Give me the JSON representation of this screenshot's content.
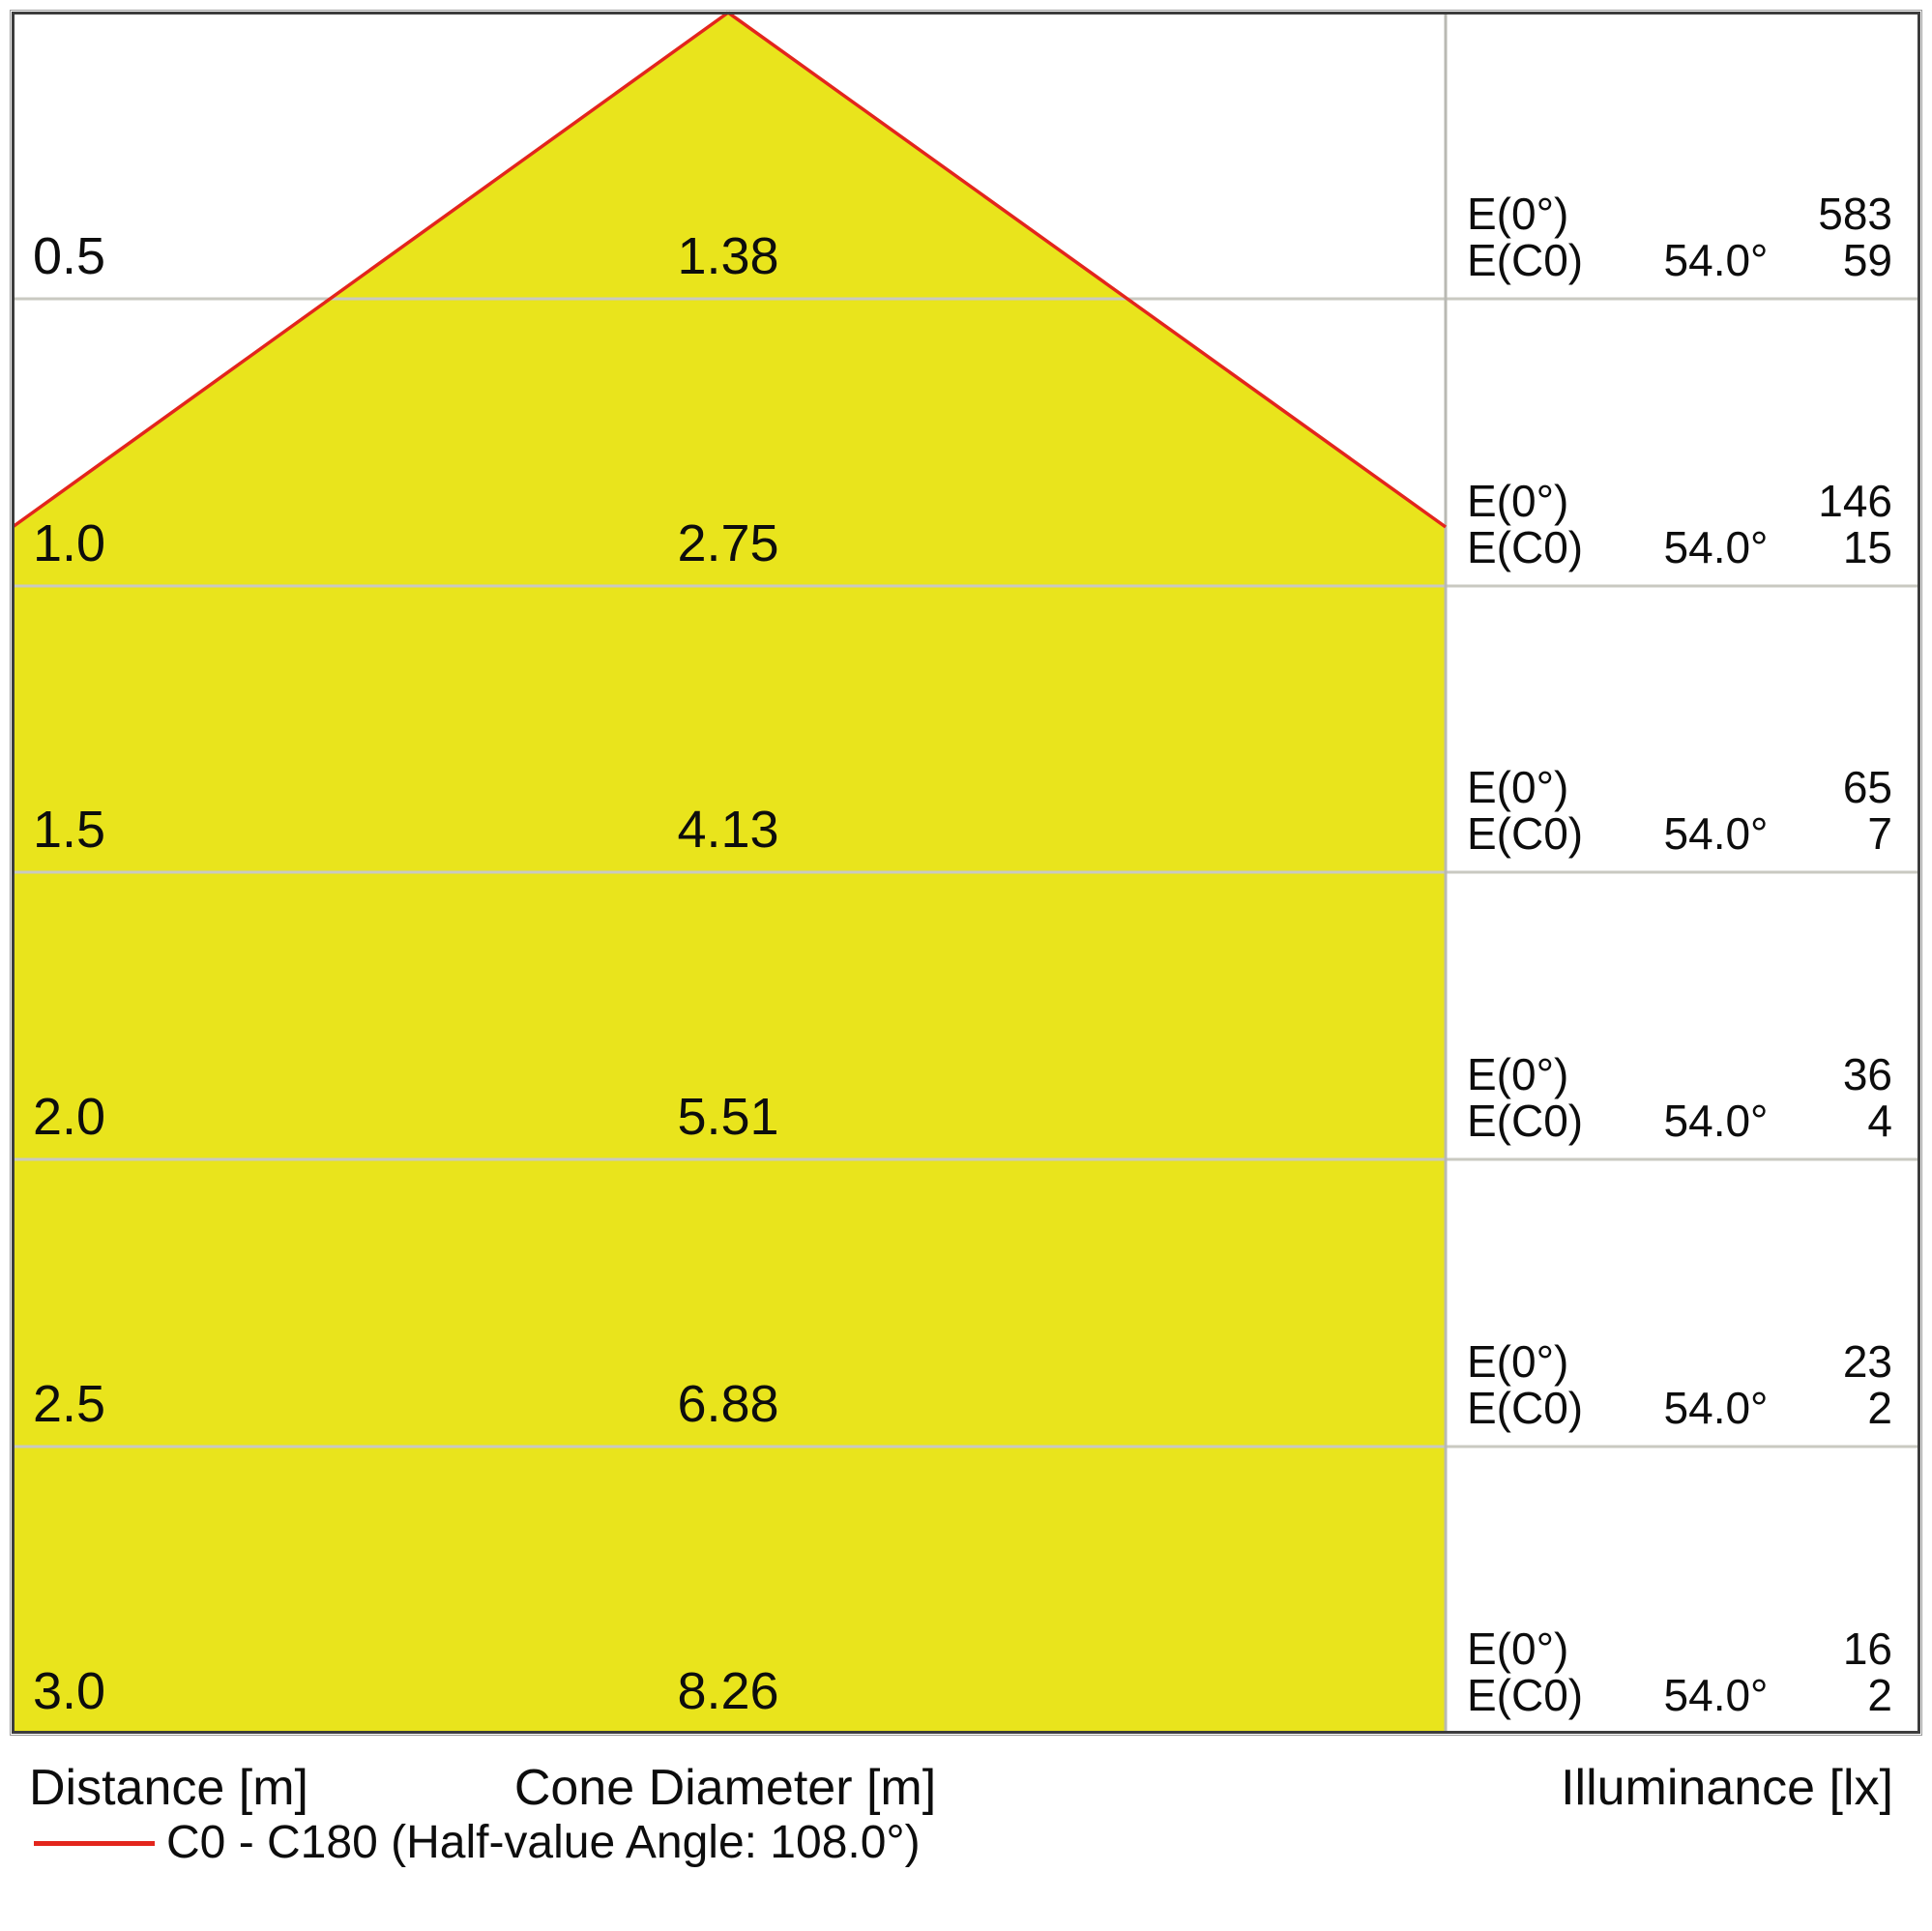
{
  "figure": {
    "labels": {
      "e0": "E(0°)",
      "ec0": "E(C0)"
    },
    "footer": {
      "distance": "Distance [m]",
      "cone_diameter": "Cone Diameter [m]",
      "illuminance": "Illuminance [lx]"
    },
    "legend": {
      "label": "C0 - C180 (Half-value Angle: 108.0°)"
    },
    "colors": {
      "cone_fill": "#e9e41c",
      "cone_edge": "#e3251c",
      "frame": "#3d3d3d",
      "grid_line": "#c9c9c1"
    }
  },
  "rows": [
    {
      "distance": "0.5",
      "diameter": "1.38",
      "e0_value": "583",
      "ec0_angle": "54.0°",
      "ec0_value": "59"
    },
    {
      "distance": "1.0",
      "diameter": "2.75",
      "e0_value": "146",
      "ec0_angle": "54.0°",
      "ec0_value": "15"
    },
    {
      "distance": "1.5",
      "diameter": "4.13",
      "e0_value": "65",
      "ec0_angle": "54.0°",
      "ec0_value": "7"
    },
    {
      "distance": "2.0",
      "diameter": "5.51",
      "e0_value": "36",
      "ec0_angle": "54.0°",
      "ec0_value": "4"
    },
    {
      "distance": "2.5",
      "diameter": "6.88",
      "e0_value": "23",
      "ec0_angle": "54.0°",
      "ec0_value": "2"
    },
    {
      "distance": "3.0",
      "diameter": "8.26",
      "e0_value": "16",
      "ec0_angle": "54.0°",
      "ec0_value": "2"
    }
  ],
  "chart_data": {
    "type": "table",
    "title": "Light cone diagram (luminaire beam spread)",
    "columns": [
      "Distance [m]",
      "Cone Diameter [m]",
      "E(0°) [lx]",
      "E(C0) angle",
      "E(C0) [lx]"
    ],
    "rows": [
      [
        0.5,
        1.38,
        583,
        "54.0°",
        59
      ],
      [
        1.0,
        2.75,
        146,
        "54.0°",
        15
      ],
      [
        1.5,
        4.13,
        65,
        "54.0°",
        7
      ],
      [
        2.0,
        5.51,
        36,
        "54.0°",
        4
      ],
      [
        2.5,
        6.88,
        23,
        "54.0°",
        2
      ],
      [
        3.0,
        8.26,
        16,
        "54.0°",
        2
      ]
    ],
    "annotations": [
      "C0 - C180 (Half-value Angle: 108.0°)"
    ],
    "layout": {
      "cone_apex": "top-center",
      "cone_fill_color": "#e9e41c",
      "cone_edge_color": "#e3251c",
      "row_count": 6,
      "grid": true,
      "legend_position": "bottom-left"
    }
  }
}
